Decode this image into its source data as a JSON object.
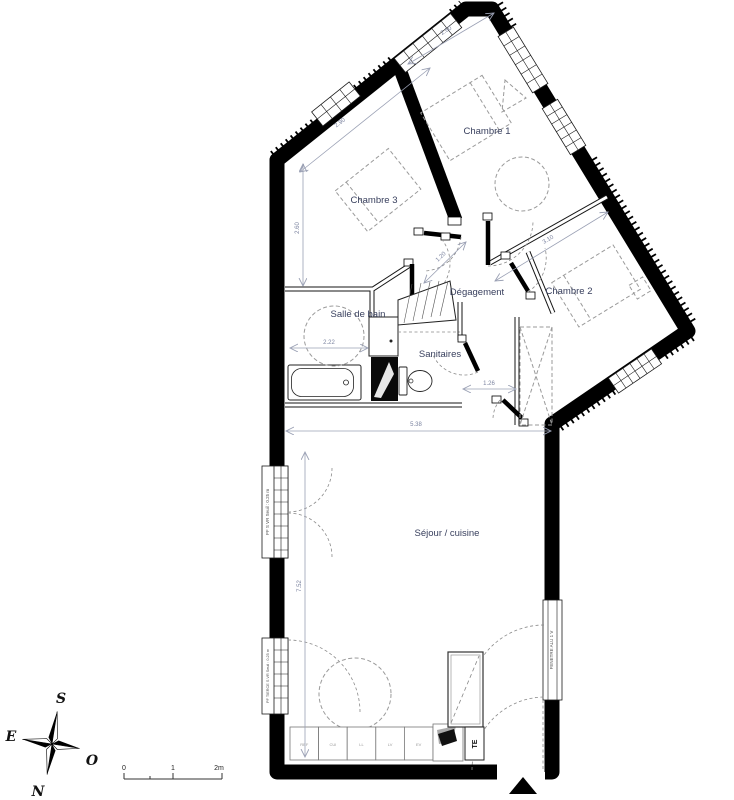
{
  "plan": {
    "rooms": {
      "chambre1": "Chambre 1",
      "chambre2": "Chambre 2",
      "chambre3": "Chambre 3",
      "degagement": "Dégagement",
      "salle_de_bain": "Salle de bain",
      "sanitaires": "Sanitaires",
      "sejour": "Séjour / cuisine"
    },
    "dimensions": {
      "top_260": "2.60",
      "nw_290": "2.90",
      "left_260": "2.60",
      "sdb_222": "2.22",
      "wc_126": "1.26",
      "sejour_538": "5.38",
      "sejour_752": "7.52",
      "deg_120": "1.20",
      "ch2_310": "3.10"
    },
    "annotations": {
      "window_left_upper": "PF S VR  Seuil : 0.25 m",
      "window_left_lower": "PF TIERCE S VR  Seuil : 0.25 m",
      "window_right": "FENETRE ALU 1 V",
      "te": "TE"
    },
    "kitchen_units": [
      "REF",
      "CUI",
      "LL",
      "LV",
      "EV"
    ],
    "compass": {
      "s": "S",
      "e": "E",
      "o": "O",
      "n": "N"
    },
    "scale_bar": {
      "zero": "0",
      "one": "1",
      "two": "2m"
    }
  }
}
